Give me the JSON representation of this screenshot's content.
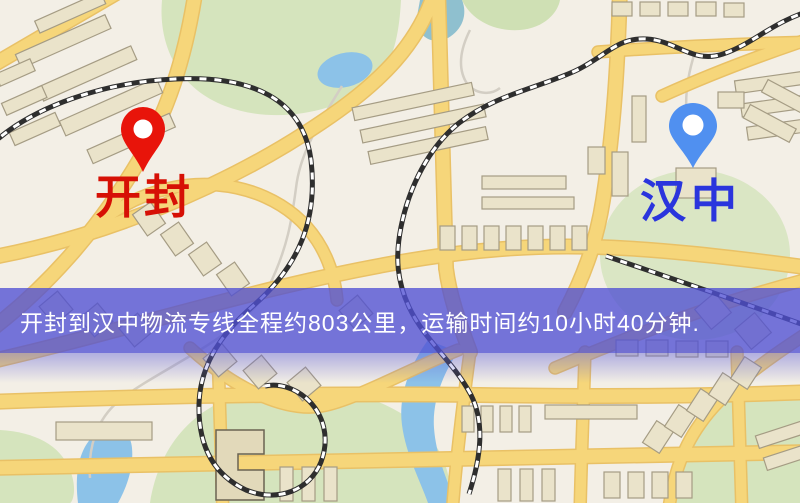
{
  "map": {
    "origin_marker": {
      "label": "开封",
      "pin_color": "#e8140a",
      "label_color": "#d61005"
    },
    "destination_marker": {
      "label": "汉中",
      "pin_color": "#5090f0",
      "label_color": "#2a35dd"
    },
    "banner": {
      "text": "开封到汉中物流专线全程约803公里，运输时间约10小时40分钟.",
      "background_color": "#5050d4",
      "text_color": "#ffffff"
    },
    "colors": {
      "land": "#f3efe6",
      "road": "#f6d67a",
      "park": "#d5e4bd",
      "water": "#8cc2e8",
      "building": "#eae3ca",
      "railway": "#2e2e2e"
    }
  }
}
